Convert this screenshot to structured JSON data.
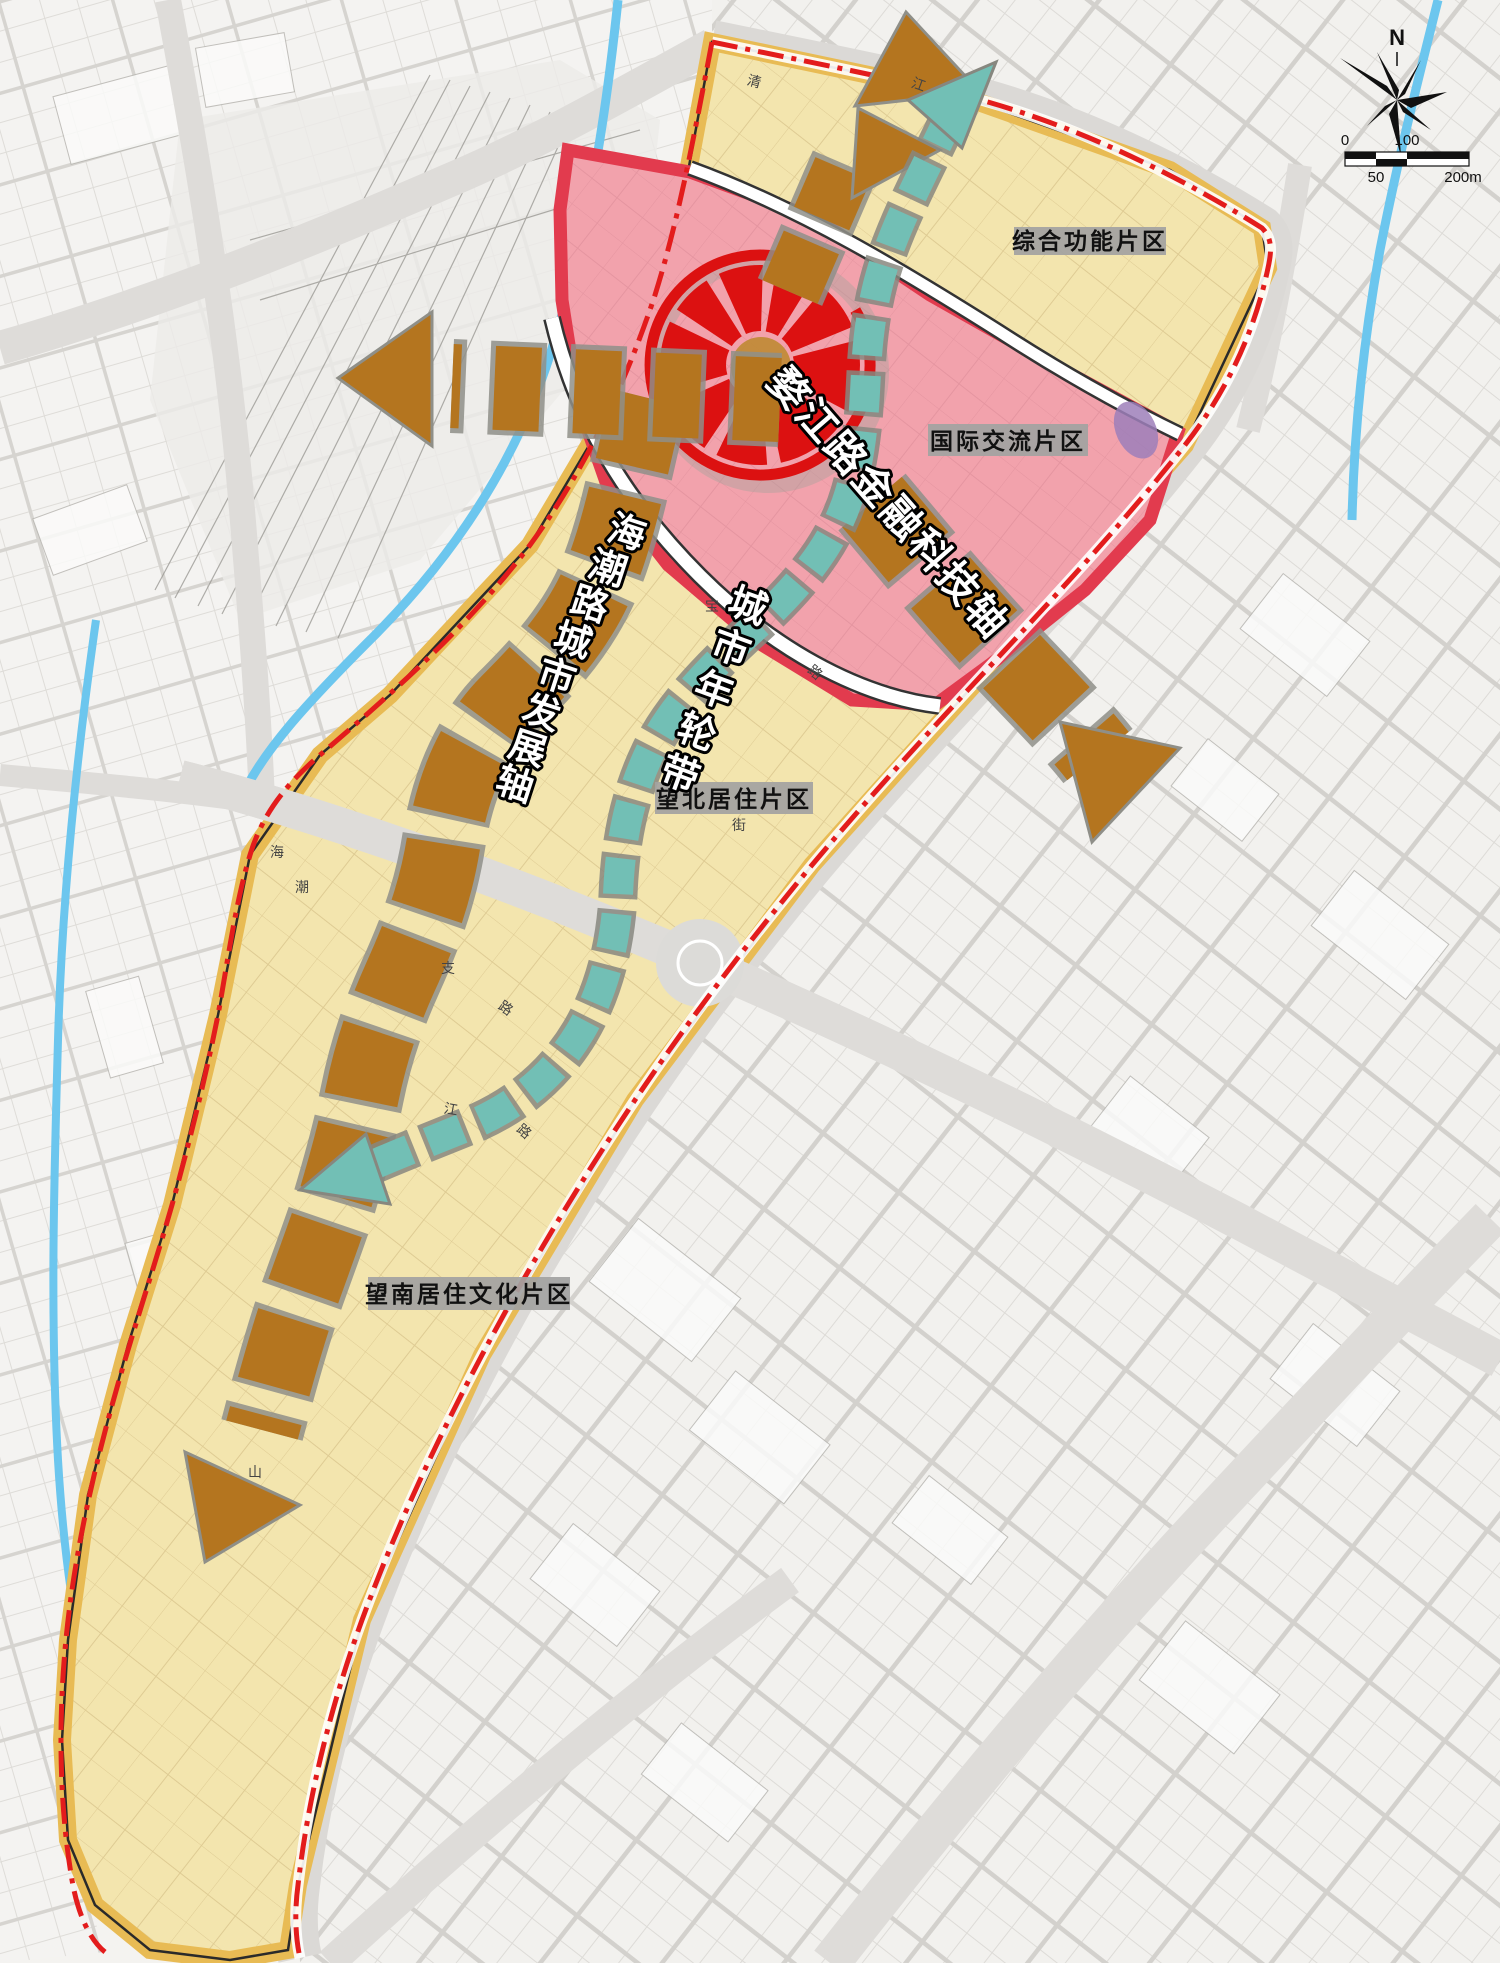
{
  "map": {
    "region_labels": [
      {
        "text": "综合功能片区"
      },
      {
        "text": "国际交流片区"
      },
      {
        "text": "望北居住片区"
      },
      {
        "text": "望南居住文化片区"
      }
    ],
    "axes": {
      "wujiang_text": "婺江路金融科技轴",
      "ring_chars": [
        "城",
        "市",
        "年",
        "轮",
        "带"
      ],
      "haichao_chars": [
        "海",
        "潮",
        "路",
        "城",
        "市",
        "发",
        "展",
        "轴"
      ]
    },
    "road_labels": [
      {
        "text": "清"
      },
      {
        "text": "江"
      },
      {
        "text": "宝"
      },
      {
        "text": "路"
      },
      {
        "text": "街"
      },
      {
        "text": "支"
      },
      {
        "text": "路"
      },
      {
        "text": "江"
      },
      {
        "text": "路"
      },
      {
        "text": "海"
      },
      {
        "text": "潮"
      },
      {
        "text": "山"
      }
    ],
    "compass": {
      "north": "N"
    },
    "scalebar": {
      "t0": "0",
      "t50": "50",
      "t100": "100",
      "t200": "200m"
    },
    "colors": {
      "zone_yellow": "#f3e5ae",
      "zone_yellow_edge": "#e8bb54",
      "zone_pink": "#f2a2ac",
      "zone_pink_edge": "#e23b4e",
      "axis_brown": "#b4751f",
      "ring_teal": "#72bfb5",
      "focus_red": "#dc1111",
      "boundary_red": "#e31c1c",
      "river_blue": "#6cc6ee"
    }
  }
}
